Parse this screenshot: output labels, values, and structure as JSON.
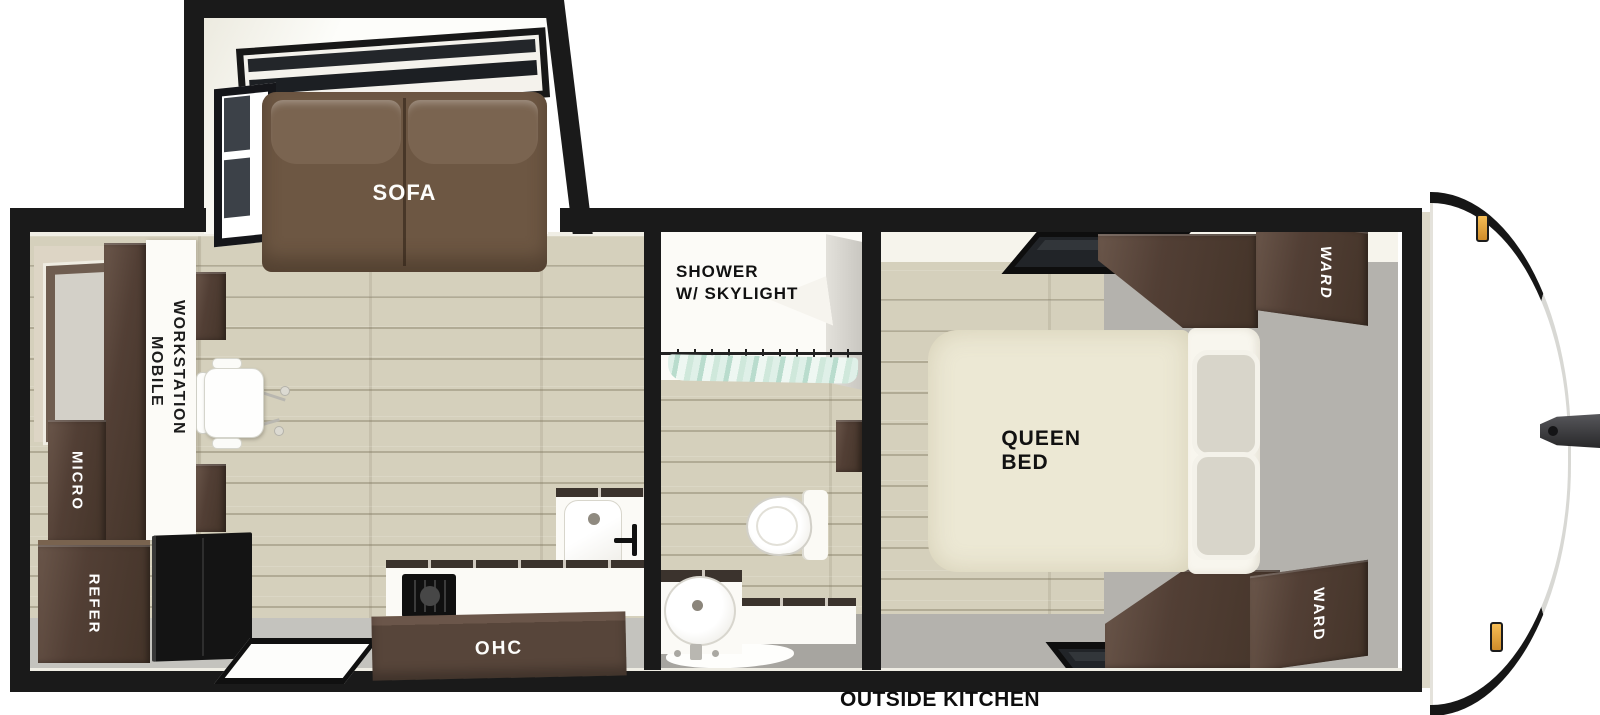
{
  "floorplan": {
    "type": "travel-trailer-floorplan",
    "labels": {
      "sofa": "SOFA",
      "workstation_line1": "MOBILE",
      "workstation_line2": "WORKSTATION",
      "micro": "MICRO",
      "refer": "REFER",
      "ohc": "OHC",
      "shower_line1": "SHOWER",
      "shower_line2": "W/ SKYLIGHT",
      "queen_bed": "QUEEN BED",
      "ward_top": "WARD",
      "ward_bottom": "WARD",
      "outside_kitchen": "OUTSIDE KITCHEN"
    },
    "colors": {
      "wall": "#1a1a1a",
      "floor_wood": "#d5d0bc",
      "floor_gray": "#b4b2ad",
      "cabinet_dark_brown": "#4e3d34",
      "cabinet_light_brown": "#6a564a",
      "sofa_brown": "#6f5a46",
      "bed_cream": "#ece8d4",
      "pillow_gray": "#d8d5ca",
      "shower_curtain_aqua": "#cfe8dc",
      "marker_amber": "#eea743",
      "fixture_white": "#fbfaf6"
    }
  }
}
